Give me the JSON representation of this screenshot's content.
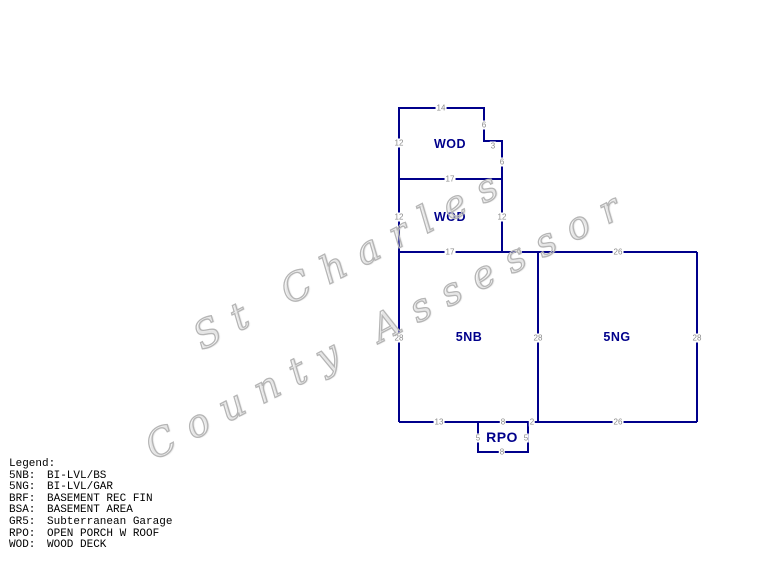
{
  "watermark": {
    "line1": "St Charles",
    "line2": "County Assessor"
  },
  "sketch": {
    "areas": {
      "wod_upper": "WOD",
      "wod_lower": "WOD",
      "nb": "5NB",
      "ng": "5NG",
      "rpo": "RPO"
    },
    "dimensions": [
      "14",
      "12",
      "6",
      "3",
      "6",
      "17",
      "12",
      "12",
      "17",
      "6",
      "26",
      "28",
      "28",
      "28",
      "13",
      "8",
      "2",
      "26",
      "5",
      "5",
      "8"
    ]
  },
  "legend": {
    "title": "Legend:",
    "entries": [
      {
        "code": "5NB:",
        "desc": "BI-LVL/BS"
      },
      {
        "code": "5NG:",
        "desc": "BI-LVL/GAR"
      },
      {
        "code": "BRF:",
        "desc": "BASEMENT REC FIN"
      },
      {
        "code": "BSA:",
        "desc": "BASEMENT AREA"
      },
      {
        "code": "GR5:",
        "desc": "Subterranean Garage"
      },
      {
        "code": "RPO:",
        "desc": "OPEN PORCH W ROOF"
      },
      {
        "code": "WOD:",
        "desc": "WOOD DECK"
      }
    ]
  },
  "colors": {
    "line": "#00008B",
    "area_label": "#00008B",
    "dimension_text": "#8a8a8a",
    "watermark_outline": "#b5b5b5",
    "legend_text": "#000000"
  }
}
